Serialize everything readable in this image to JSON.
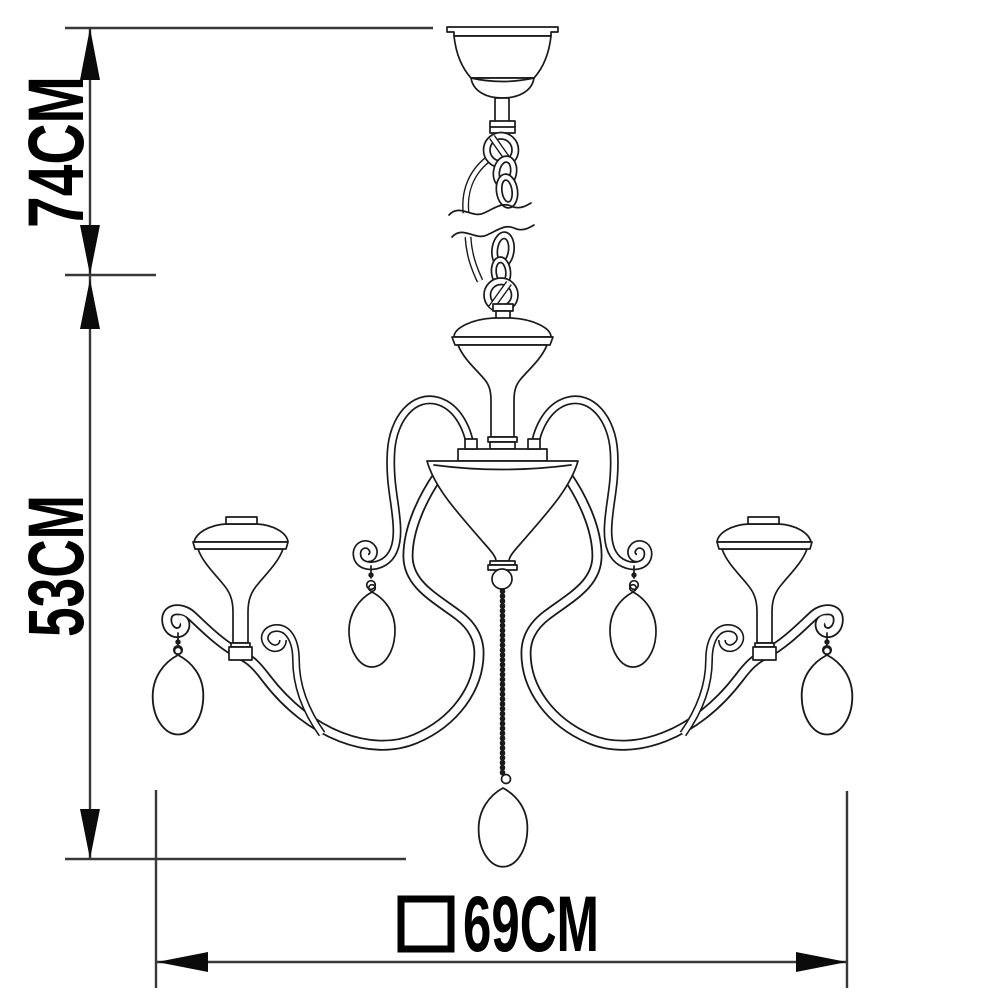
{
  "diagram": {
    "subject": "chandelier-dimension-drawing",
    "style": {
      "line_color": "#1a1a1a",
      "dimension_line_color": "#383838",
      "text_color": "#000000",
      "background": "#ffffff"
    },
    "dimensions": {
      "hang_height": {
        "value": "74CM",
        "axis": "vertical",
        "position": "top-left"
      },
      "body_height": {
        "value": "53CM",
        "axis": "vertical",
        "position": "bottom-left"
      },
      "width": {
        "value": "69CM",
        "axis": "horizontal",
        "position": "bottom",
        "symbol_shape": "square"
      }
    },
    "icons": [
      "arrowhead-up-icon",
      "arrowhead-down-icon",
      "arrowhead-left-icon",
      "arrowhead-right-icon",
      "square-symbol-icon",
      "break-line-symbol"
    ]
  }
}
